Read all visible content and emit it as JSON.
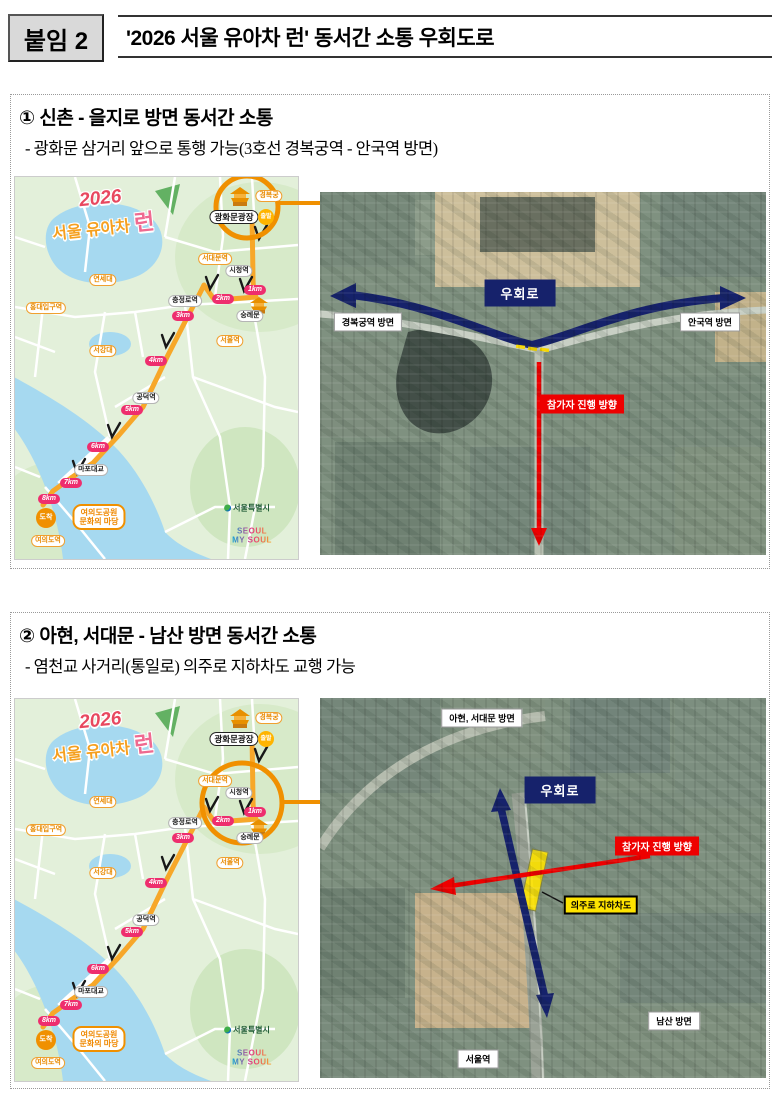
{
  "header": {
    "tag": "붙임 2",
    "title": "'2026 서울 유아차 런' 동서간 소통 우회도로"
  },
  "section1": {
    "heading": "① 신촌 - 을지로 방면 동서간 소통",
    "subheading": "- 광화문 삼거리 앞으로 통행 가능(3호선 경복궁역 - 안국역 방면)"
  },
  "section2": {
    "heading": "② 아현, 서대문 - 남산 방면 동서간 소통",
    "subheading": "- 염천교 사거리(통일로) 의주로 지하차도 교행 가능"
  },
  "route_map": {
    "logo": {
      "year": "2026",
      "title": "서울 유아차",
      "run": "런"
    },
    "start": {
      "label": "광화문광장",
      "badge": "출발"
    },
    "finish": {
      "badge": "도착",
      "line1": "여의도공원",
      "line2": "문화의 마당"
    },
    "stations": {
      "gyeongbokgung": "경복궁",
      "cityhall": "시청역",
      "sungnyemun": "숭례문",
      "chungjeongno": "충정로역",
      "seodaemun": "서대문역",
      "yonsei": "연세대",
      "hongdae": "홍대입구역",
      "sogang": "서강대",
      "seoul_station": "서울역",
      "gongdeok": "공덕역",
      "mapo_bridge": "마포대교",
      "yeouido": "여의도역"
    },
    "km": [
      "1km",
      "2km",
      "3km",
      "4km",
      "5km",
      "6km",
      "7km",
      "8km"
    ],
    "city": "서울특별시",
    "brand1": "SEOUL",
    "brand2": "MY SOUL"
  },
  "sat1": {
    "detour": "우회로",
    "left": "경복궁역 방면",
    "right": "안국역 방면",
    "flow": "참가자 진행 방향"
  },
  "sat2": {
    "detour": "우회로",
    "top": "아현, 서대문 방면",
    "flow": "참가자 진행 방향",
    "underpass": "의주로 지하차도",
    "namsan": "남산 방면",
    "station": "서울역"
  },
  "colors": {
    "navy": "#16226b",
    "red": "#ee0000",
    "orange": "#f09000",
    "route_orange": "#f7a729",
    "pink": "#ee2e6e",
    "yellow": "#ffe400",
    "water": "#a6d9f0",
    "map_green": "#e3f0da"
  }
}
